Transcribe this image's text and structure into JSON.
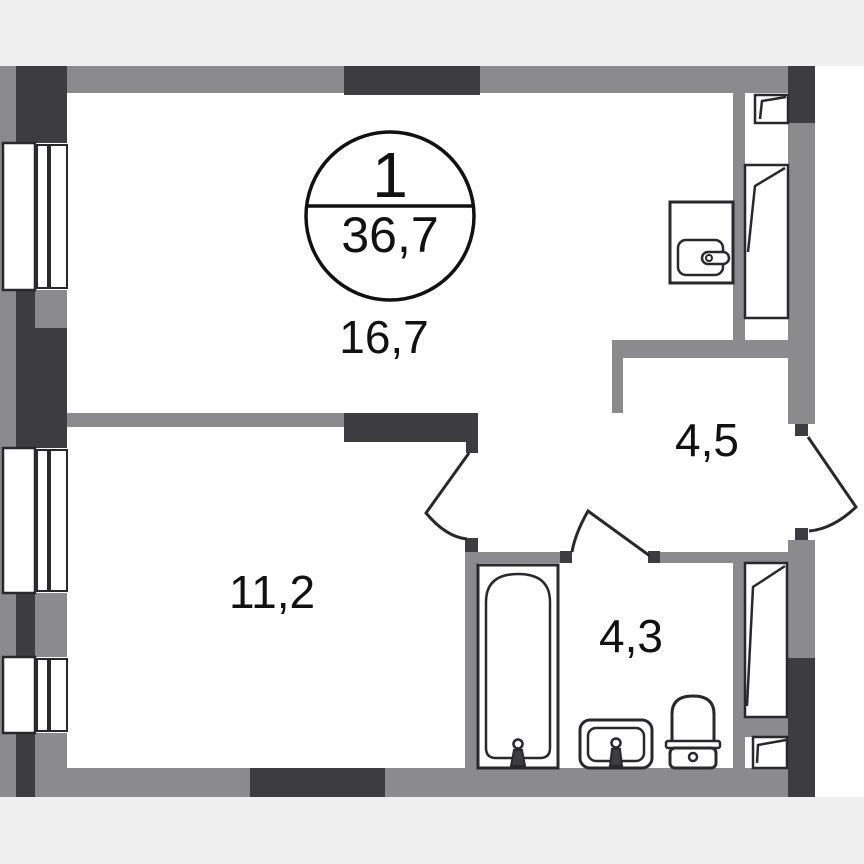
{
  "legend": {
    "rooms_count": "1",
    "total_area": "36,7"
  },
  "room_labels": {
    "living": "16,7",
    "bedroom": "11,2",
    "hallway": "4,5",
    "bathroom": "4,3"
  },
  "fixtures": [
    "kitchen-sink",
    "bathtub",
    "washbasin",
    "toilet"
  ],
  "symbols": [
    "window",
    "vent-window",
    "door-swing",
    "rooms-over-area-circle"
  ],
  "colors": {
    "wall_gray": "#8b8b8e",
    "wall_dark": "#3d3d3f",
    "outline": "#29292c",
    "floor": "#ffffff",
    "background": "#efeff0",
    "text": "#111111"
  }
}
